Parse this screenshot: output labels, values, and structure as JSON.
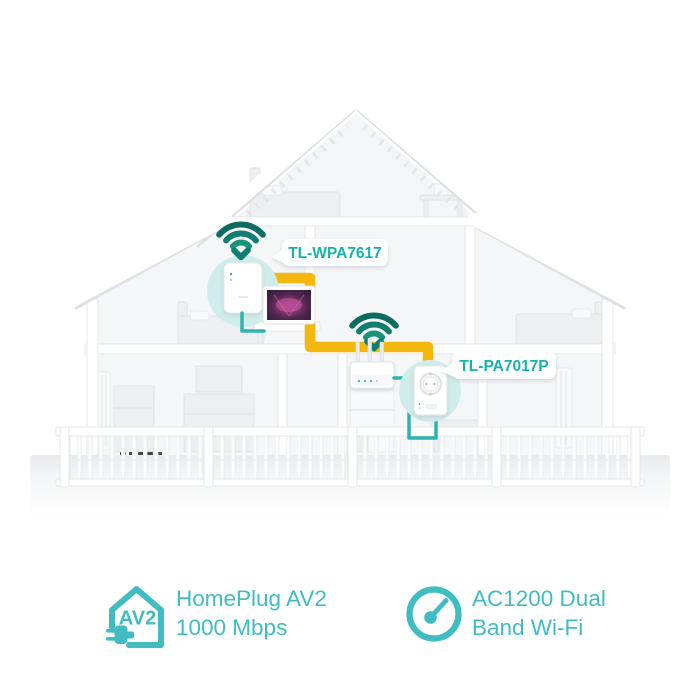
{
  "devices": {
    "extender": {
      "label": "TL-WPA7617"
    },
    "adapter": {
      "label": "TL-PA7017P"
    }
  },
  "icons": {
    "wifi": "wifi-signal-down-arrow-icon",
    "feature1": "homeplug-av2-house-plug-icon",
    "feature2": "speedometer-icon"
  },
  "features": [
    {
      "badge": "AV2",
      "line1": "HomePlug AV2",
      "line2": "1000 Mbps"
    },
    {
      "line1": "AC1200 Dual",
      "line2": "Band Wi-Fi"
    }
  ],
  "colors": {
    "feature_teal": "#3fbdc3",
    "label_teal": "#16b3ac",
    "wifi_dark": "#0d6b62",
    "wifi_mid": "#117d6f",
    "wifi_light": "#189379",
    "cable_yellow": "#f3b70e",
    "cable_ethernet": "#2fb3ae",
    "device_halo": "#cfedea",
    "wall_white": "#ffffff",
    "room_gray": "#f5f6f8"
  }
}
